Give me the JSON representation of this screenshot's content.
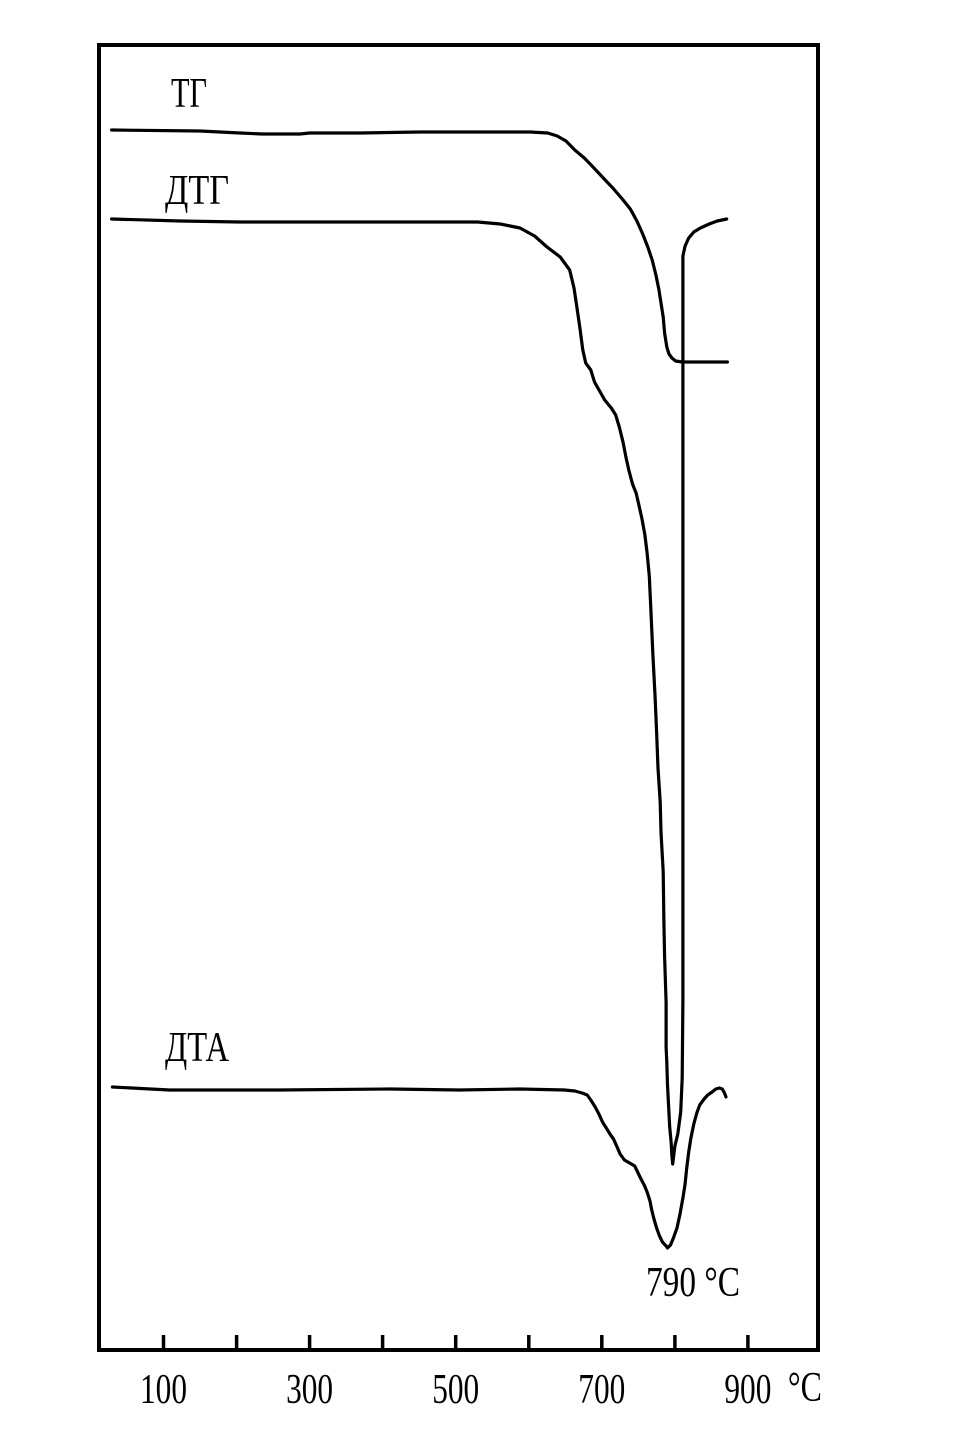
{
  "figure": {
    "kind": "thermal-analysis-thermogram",
    "background_color": "#ffffff",
    "ink_color": "#000000",
    "description": "Simultaneous thermal analysis curves TG (ТГ), DTG (ДТГ) and DTA (ДТА) versus temperature; no vertical scale is shown in the original, so y values are recorded as pixel positions (top-down) of the source image."
  },
  "chart_data": {
    "type": "line",
    "title": "",
    "x_axis": {
      "unit": "°C",
      "ticks_degC": [
        100,
        200,
        300,
        400,
        500,
        600,
        700,
        800,
        900
      ],
      "labeled_ticks_degC": [
        100,
        300,
        500,
        700,
        900
      ],
      "range_degC": [
        8,
        996
      ],
      "grid": false
    },
    "y_axis": {
      "scale_shown": false,
      "units": "arbitrary (pixel y of source image, top-down)"
    },
    "legend_position": "labels drawn above each curve inside plot",
    "key_readings": {
      "dta_endotherm_peak_degC": 790,
      "dtg_peak_degC": 790,
      "tg_mass_loss_onset_degC": 638,
      "tg_mass_loss_complete_degC": 806
    },
    "series": [
      {
        "id": "tg",
        "name": "ТГ",
        "points": [
          [
            29,
            130
          ],
          [
            150,
            131
          ],
          [
            205,
            133
          ],
          [
            235,
            134
          ],
          [
            287,
            134
          ],
          [
            300,
            133
          ],
          [
            369,
            133
          ],
          [
            451,
            132
          ],
          [
            533,
            132
          ],
          [
            602,
            132
          ],
          [
            626,
            133
          ],
          [
            639,
            136
          ],
          [
            651,
            141
          ],
          [
            663,
            150
          ],
          [
            676,
            158
          ],
          [
            688,
            167
          ],
          [
            702,
            178
          ],
          [
            715,
            188
          ],
          [
            728,
            199
          ],
          [
            739,
            209
          ],
          [
            748,
            221
          ],
          [
            756,
            234
          ],
          [
            763,
            247
          ],
          [
            769,
            260
          ],
          [
            774,
            275
          ],
          [
            778,
            289
          ],
          [
            781,
            303
          ],
          [
            784,
            317
          ],
          [
            786,
            333
          ],
          [
            789,
            347
          ],
          [
            792,
            354
          ],
          [
            796,
            358
          ],
          [
            801,
            361
          ],
          [
            810,
            362
          ],
          [
            872,
            362
          ]
        ]
      },
      {
        "id": "dtg",
        "name": "ДТГ",
        "points": [
          [
            29,
            219
          ],
          [
            123,
            221
          ],
          [
            205,
            222
          ],
          [
            396,
            222
          ],
          [
            530,
            222
          ],
          [
            561,
            224
          ],
          [
            588,
            228
          ],
          [
            608,
            236
          ],
          [
            625,
            247
          ],
          [
            643,
            257
          ],
          [
            656,
            270
          ],
          [
            662,
            288
          ],
          [
            666,
            308
          ],
          [
            670,
            328
          ],
          [
            674,
            350
          ],
          [
            678,
            363
          ],
          [
            685,
            370
          ],
          [
            690,
            382
          ],
          [
            697,
            391
          ],
          [
            704,
            400
          ],
          [
            713,
            408
          ],
          [
            719,
            415
          ],
          [
            724,
            427
          ],
          [
            729,
            442
          ],
          [
            733,
            457
          ],
          [
            737,
            470
          ],
          [
            742,
            484
          ],
          [
            747,
            493
          ],
          [
            751,
            506
          ],
          [
            755,
            519
          ],
          [
            759,
            535
          ],
          [
            762,
            553
          ],
          [
            765,
            576
          ],
          [
            767,
            606
          ],
          [
            770,
            655
          ],
          [
            773,
            697
          ],
          [
            775,
            732
          ],
          [
            777,
            768
          ],
          [
            780,
            802
          ],
          [
            781,
            832
          ],
          [
            784,
            872
          ],
          [
            785,
            922
          ],
          [
            786,
            957
          ],
          [
            788,
            1002
          ],
          [
            788,
            1047
          ],
          [
            789,
            1062
          ],
          [
            790,
            1085
          ],
          [
            793,
            1127
          ],
          [
            795,
            1143
          ],
          [
            796,
            1156
          ],
          [
            797,
            1164
          ],
          [
            800,
            1146
          ],
          [
            804,
            1134
          ],
          [
            808,
            1112
          ],
          [
            810,
            1078
          ],
          [
            811,
            1000
          ],
          [
            811,
            700
          ],
          [
            811,
            400
          ],
          [
            811,
            256
          ],
          [
            814,
            246
          ],
          [
            819,
            238
          ],
          [
            826,
            232
          ],
          [
            835,
            228
          ],
          [
            847,
            224
          ],
          [
            858,
            221
          ],
          [
            871,
            219
          ]
        ]
      },
      {
        "id": "dta",
        "name": "ДТА",
        "points": [
          [
            30,
            1087
          ],
          [
            108,
            1090
          ],
          [
            259,
            1090
          ],
          [
            410,
            1089
          ],
          [
            505,
            1090
          ],
          [
            588,
            1089
          ],
          [
            649,
            1090
          ],
          [
            663,
            1091
          ],
          [
            673,
            1093
          ],
          [
            680,
            1095
          ],
          [
            685,
            1100
          ],
          [
            691,
            1107
          ],
          [
            696,
            1114
          ],
          [
            701,
            1122
          ],
          [
            707,
            1129
          ],
          [
            712,
            1135
          ],
          [
            716,
            1139
          ],
          [
            721,
            1147
          ],
          [
            725,
            1154
          ],
          [
            731,
            1160
          ],
          [
            738,
            1163
          ],
          [
            745,
            1166
          ],
          [
            749,
            1172
          ],
          [
            753,
            1178
          ],
          [
            758,
            1185
          ],
          [
            762,
            1192
          ],
          [
            766,
            1201
          ],
          [
            768,
            1209
          ],
          [
            771,
            1218
          ],
          [
            775,
            1228
          ],
          [
            779,
            1236
          ],
          [
            783,
            1242
          ],
          [
            788,
            1246
          ],
          [
            790,
            1248
          ],
          [
            794,
            1245
          ],
          [
            798,
            1238
          ],
          [
            803,
            1228
          ],
          [
            807,
            1214
          ],
          [
            811,
            1198
          ],
          [
            814,
            1184
          ],
          [
            816,
            1170
          ],
          [
            819,
            1152
          ],
          [
            822,
            1138
          ],
          [
            826,
            1124
          ],
          [
            830,
            1113
          ],
          [
            834,
            1105
          ],
          [
            840,
            1099
          ],
          [
            845,
            1095
          ],
          [
            851,
            1092
          ],
          [
            856,
            1089
          ],
          [
            861,
            1088
          ],
          [
            865,
            1089
          ],
          [
            868,
            1093
          ],
          [
            870,
            1097
          ]
        ]
      }
    ],
    "annotations": [
      {
        "id": "tg-curve-label",
        "text": "ТГ",
        "role": "curve-label",
        "x_px": 171,
        "y_px": 107,
        "w_px": 36
      },
      {
        "id": "dtg-curve-label",
        "text": "ДТГ",
        "role": "curve-label",
        "x_px": 165,
        "y_px": 204,
        "w_px": 64
      },
      {
        "id": "dta-curve-label",
        "text": "ДТА",
        "role": "curve-label",
        "x_px": 165,
        "y_px": 1061,
        "w_px": 64
      },
      {
        "id": "peak-temperature-label",
        "text": "790 °C",
        "role": "peak-temperature",
        "x_px": 646,
        "y_px": 1296,
        "w_px": 94
      }
    ],
    "layout": {
      "plot": {
        "x": 97,
        "y": 45,
        "w": 721,
        "h": 1305
      },
      "x_at_100C_px": 163.5,
      "px_per_degC": 0.7305,
      "tick_len": 13,
      "tick_label_baseline_y": 1403,
      "tick_label_w_px": 47,
      "unit_label_w_px": 34,
      "unit_label_offset_px": 40,
      "curve_stroke_px": 3.2,
      "border_stroke_px": 4
    }
  }
}
